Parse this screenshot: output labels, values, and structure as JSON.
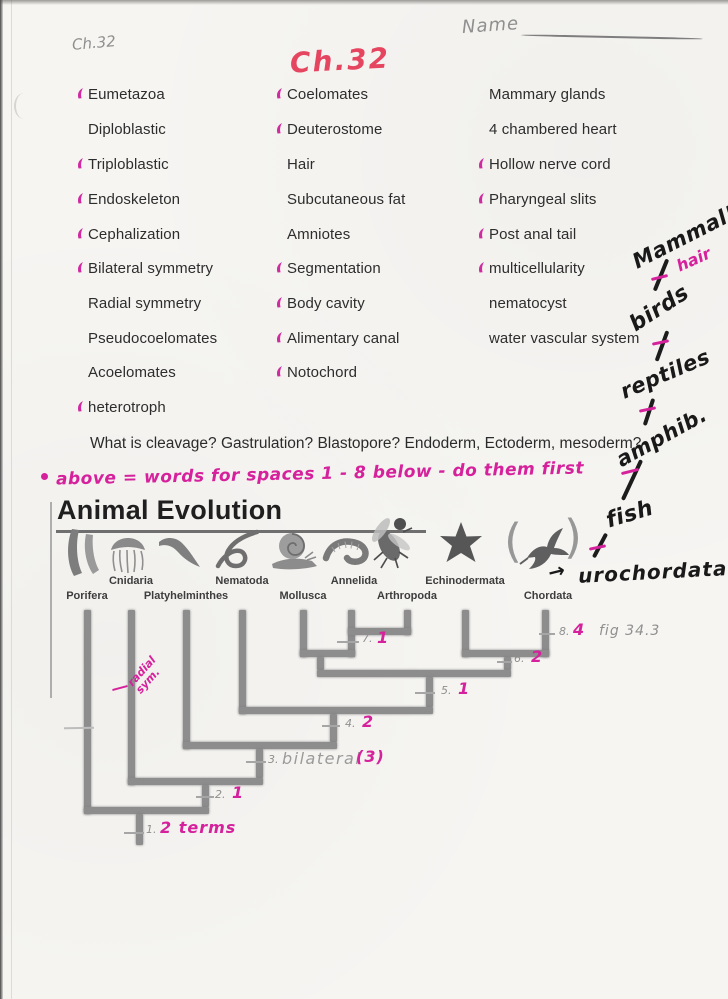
{
  "header": {
    "chapter_pencil": "Ch.32",
    "chapter_pink": "Ch.32",
    "name_label": "Name"
  },
  "terms": {
    "col1": [
      {
        "label": "Eumetazoa",
        "marked": true
      },
      {
        "label": "Diploblastic",
        "marked": false
      },
      {
        "label": "Triploblastic",
        "marked": true
      },
      {
        "label": "Endoskeleton",
        "marked": true
      },
      {
        "label": "Cephalization",
        "marked": true
      },
      {
        "label": "Bilateral symmetry",
        "marked": true
      },
      {
        "label": "Radial symmetry",
        "marked": false
      },
      {
        "label": "Pseudocoelomates",
        "marked": false
      },
      {
        "label": "Acoelomates",
        "marked": false
      },
      {
        "label": "heterotroph",
        "marked": true
      }
    ],
    "col2": [
      {
        "label": "Coelomates",
        "marked": true
      },
      {
        "label": "Deuterostome",
        "marked": true
      },
      {
        "label": "Hair",
        "marked": false
      },
      {
        "label": "Subcutaneous fat",
        "marked": false
      },
      {
        "label": "Amniotes",
        "marked": false
      },
      {
        "label": "Segmentation",
        "marked": true
      },
      {
        "label": "Body cavity",
        "marked": true
      },
      {
        "label": "Alimentary canal",
        "marked": true
      },
      {
        "label": "Notochord",
        "marked": true
      }
    ],
    "col3": [
      {
        "label": "Mammary glands",
        "marked": false
      },
      {
        "label": "4 chambered heart",
        "marked": false
      },
      {
        "label": "Hollow nerve cord",
        "marked": true
      },
      {
        "label": "Pharyngeal slits",
        "marked": true
      },
      {
        "label": "Post anal tail",
        "marked": true
      },
      {
        "label": "multicellularity",
        "marked": true
      },
      {
        "label": "nematocyst",
        "marked": false
      },
      {
        "label": "water vascular system",
        "marked": false
      }
    ]
  },
  "question": "What is cleavage? Gastrulation? Blastopore? Endoderm, Ectoderm, mesoderm?",
  "pink_note": "above = words for spaces 1 - 8 below - do them first",
  "chain": {
    "mammal": "Mammal!",
    "hair": "hair",
    "birds": "birds",
    "reptiles": "reptiles",
    "amphib": "amphib.",
    "fish": "fish",
    "arrow": "→",
    "urochordata": "urochordata"
  },
  "figure": {
    "title": "Animal Evolution",
    "fig_ref": "fig 34.3",
    "phyla": [
      "Porifera",
      "Cnidaria",
      "Platyhelminthes",
      "Nematoda",
      "Mollusca",
      "Annelida",
      "Arthropoda",
      "Echinodermata",
      "Chordata"
    ],
    "annotation": {
      "line1": "radial",
      "line2": "sym."
    },
    "nodes": [
      {
        "num": "1.",
        "answer": "2 terms"
      },
      {
        "num": "2.",
        "answer": "1"
      },
      {
        "num": "3.",
        "pencil": "bilateral",
        "answer": "(3)"
      },
      {
        "num": "4.",
        "answer": "2"
      },
      {
        "num": "5.",
        "answer": "1"
      },
      {
        "num": "6.",
        "answer": "2"
      },
      {
        "num": "7.",
        "answer": "1"
      },
      {
        "num": "8.",
        "answer": "4"
      }
    ]
  },
  "colors": {
    "pink_ink": "#d6219c",
    "red_pink_ink": "#e64560",
    "marker_ink": "#1c1c1c",
    "pencil": "#8f8f8f",
    "print": "#2d2d2d"
  }
}
